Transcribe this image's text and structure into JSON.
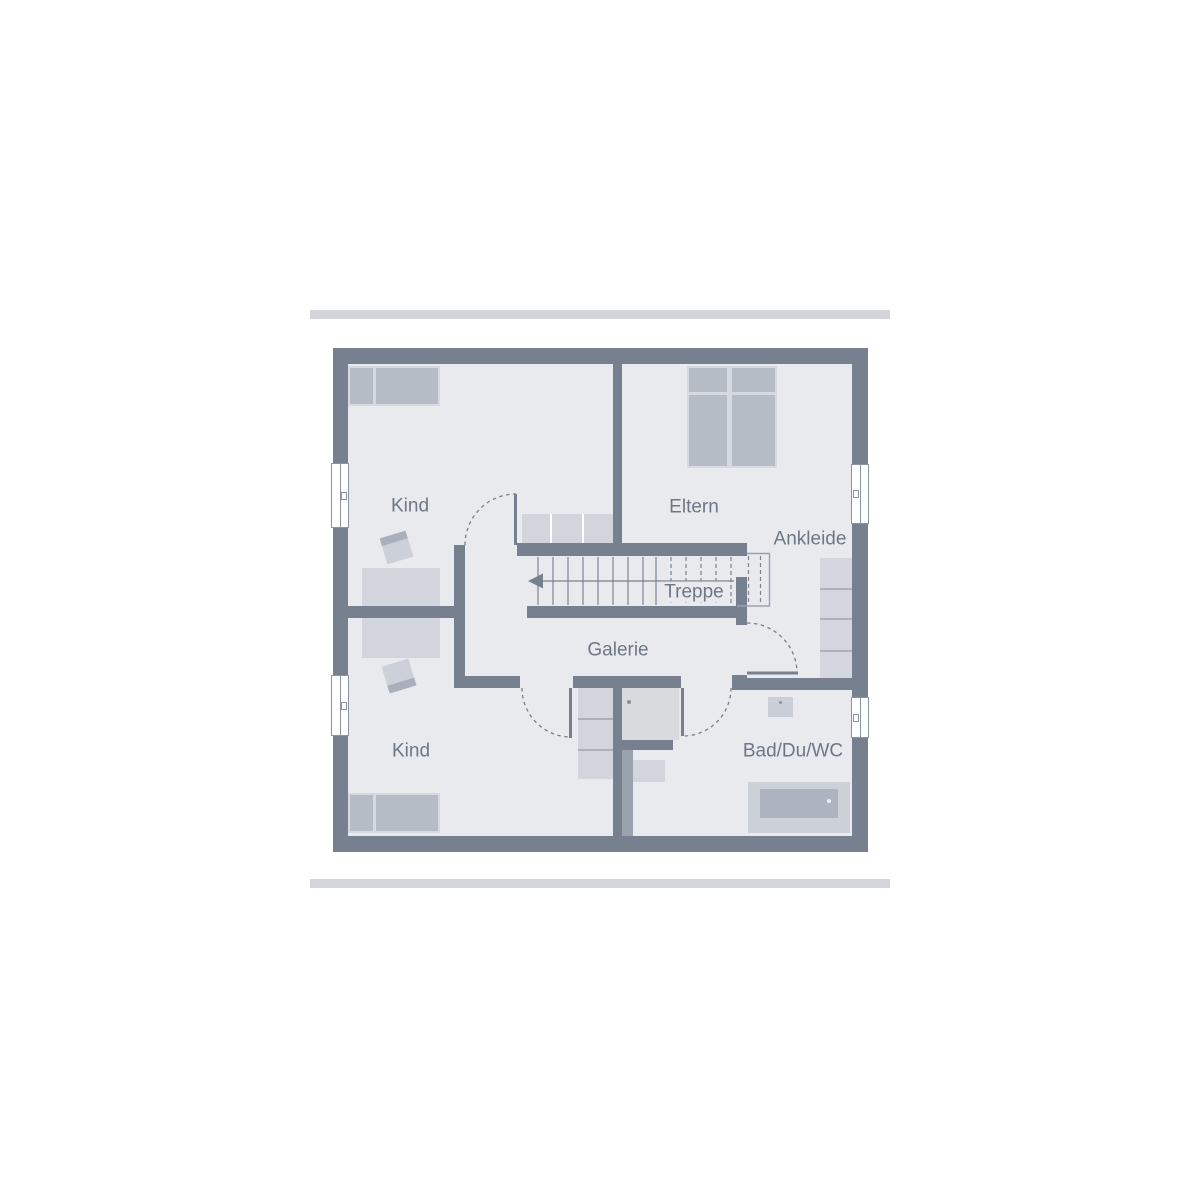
{
  "floorplan": {
    "type": "upper-floor plan",
    "rooms": [
      {
        "id": "kind_top",
        "label": "Kind"
      },
      {
        "id": "eltern",
        "label": "Eltern"
      },
      {
        "id": "ankleide",
        "label": "Ankleide"
      },
      {
        "id": "galerie",
        "label": "Galerie"
      },
      {
        "id": "kind_bottom",
        "label": "Kind"
      },
      {
        "id": "bad",
        "label": "Bad/Du/WC"
      }
    ],
    "stairs": {
      "label": "Treppe",
      "direction_arrow": "left"
    },
    "window_count": 4,
    "door_count": 4,
    "palette": {
      "wall": "#76808f",
      "floor": "#e8eaee",
      "furniture_dark": "#b5bcc6",
      "furniture_light": "#d2d6dc",
      "frame_bar": "#d3d5da",
      "label_text": "#6e7787"
    }
  }
}
